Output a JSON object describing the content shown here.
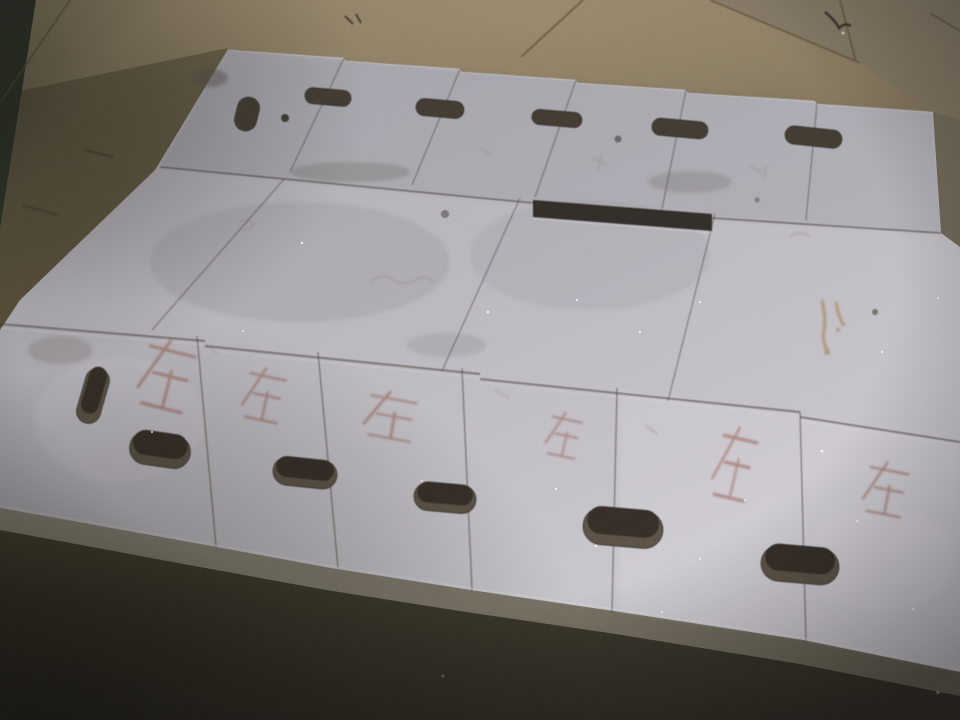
{
  "scene": {
    "description": "Low-light indoor photo: three rows of white rectangular boards with stadium-shaped handle cutouts laid flat on a brown floor; red handwritten characters mark the near row of boards",
    "floor": {
      "tone_top": "#8c7d63",
      "tone_mid": "#675a41",
      "tone_bottom": "#2f2b22",
      "dark_object_color": "#2a3126"
    },
    "boards": {
      "surface_light": "#cfccd3",
      "surface_dark": "#aeabb2",
      "cut_edge_color": "#8b8577",
      "rows": 3,
      "row_board_counts": [
        6,
        4,
        6
      ],
      "row1_slots": 6,
      "row1_round_holes": 1,
      "row3_slots": 6,
      "slot_color_far": "#3f382e",
      "slot_color_near_wall": "#5a5043",
      "slot_color_near_hole": "#332c23"
    },
    "markings": {
      "ink_color": "#925240",
      "pencil_color": "#8f8578",
      "stain_color": "#a3814f",
      "items": [
        {
          "char": "在"
        },
        {
          "char": "在"
        },
        {
          "char": "在"
        },
        {
          "char": "在"
        },
        {
          "char": "在"
        },
        {
          "char": "在"
        }
      ]
    }
  }
}
